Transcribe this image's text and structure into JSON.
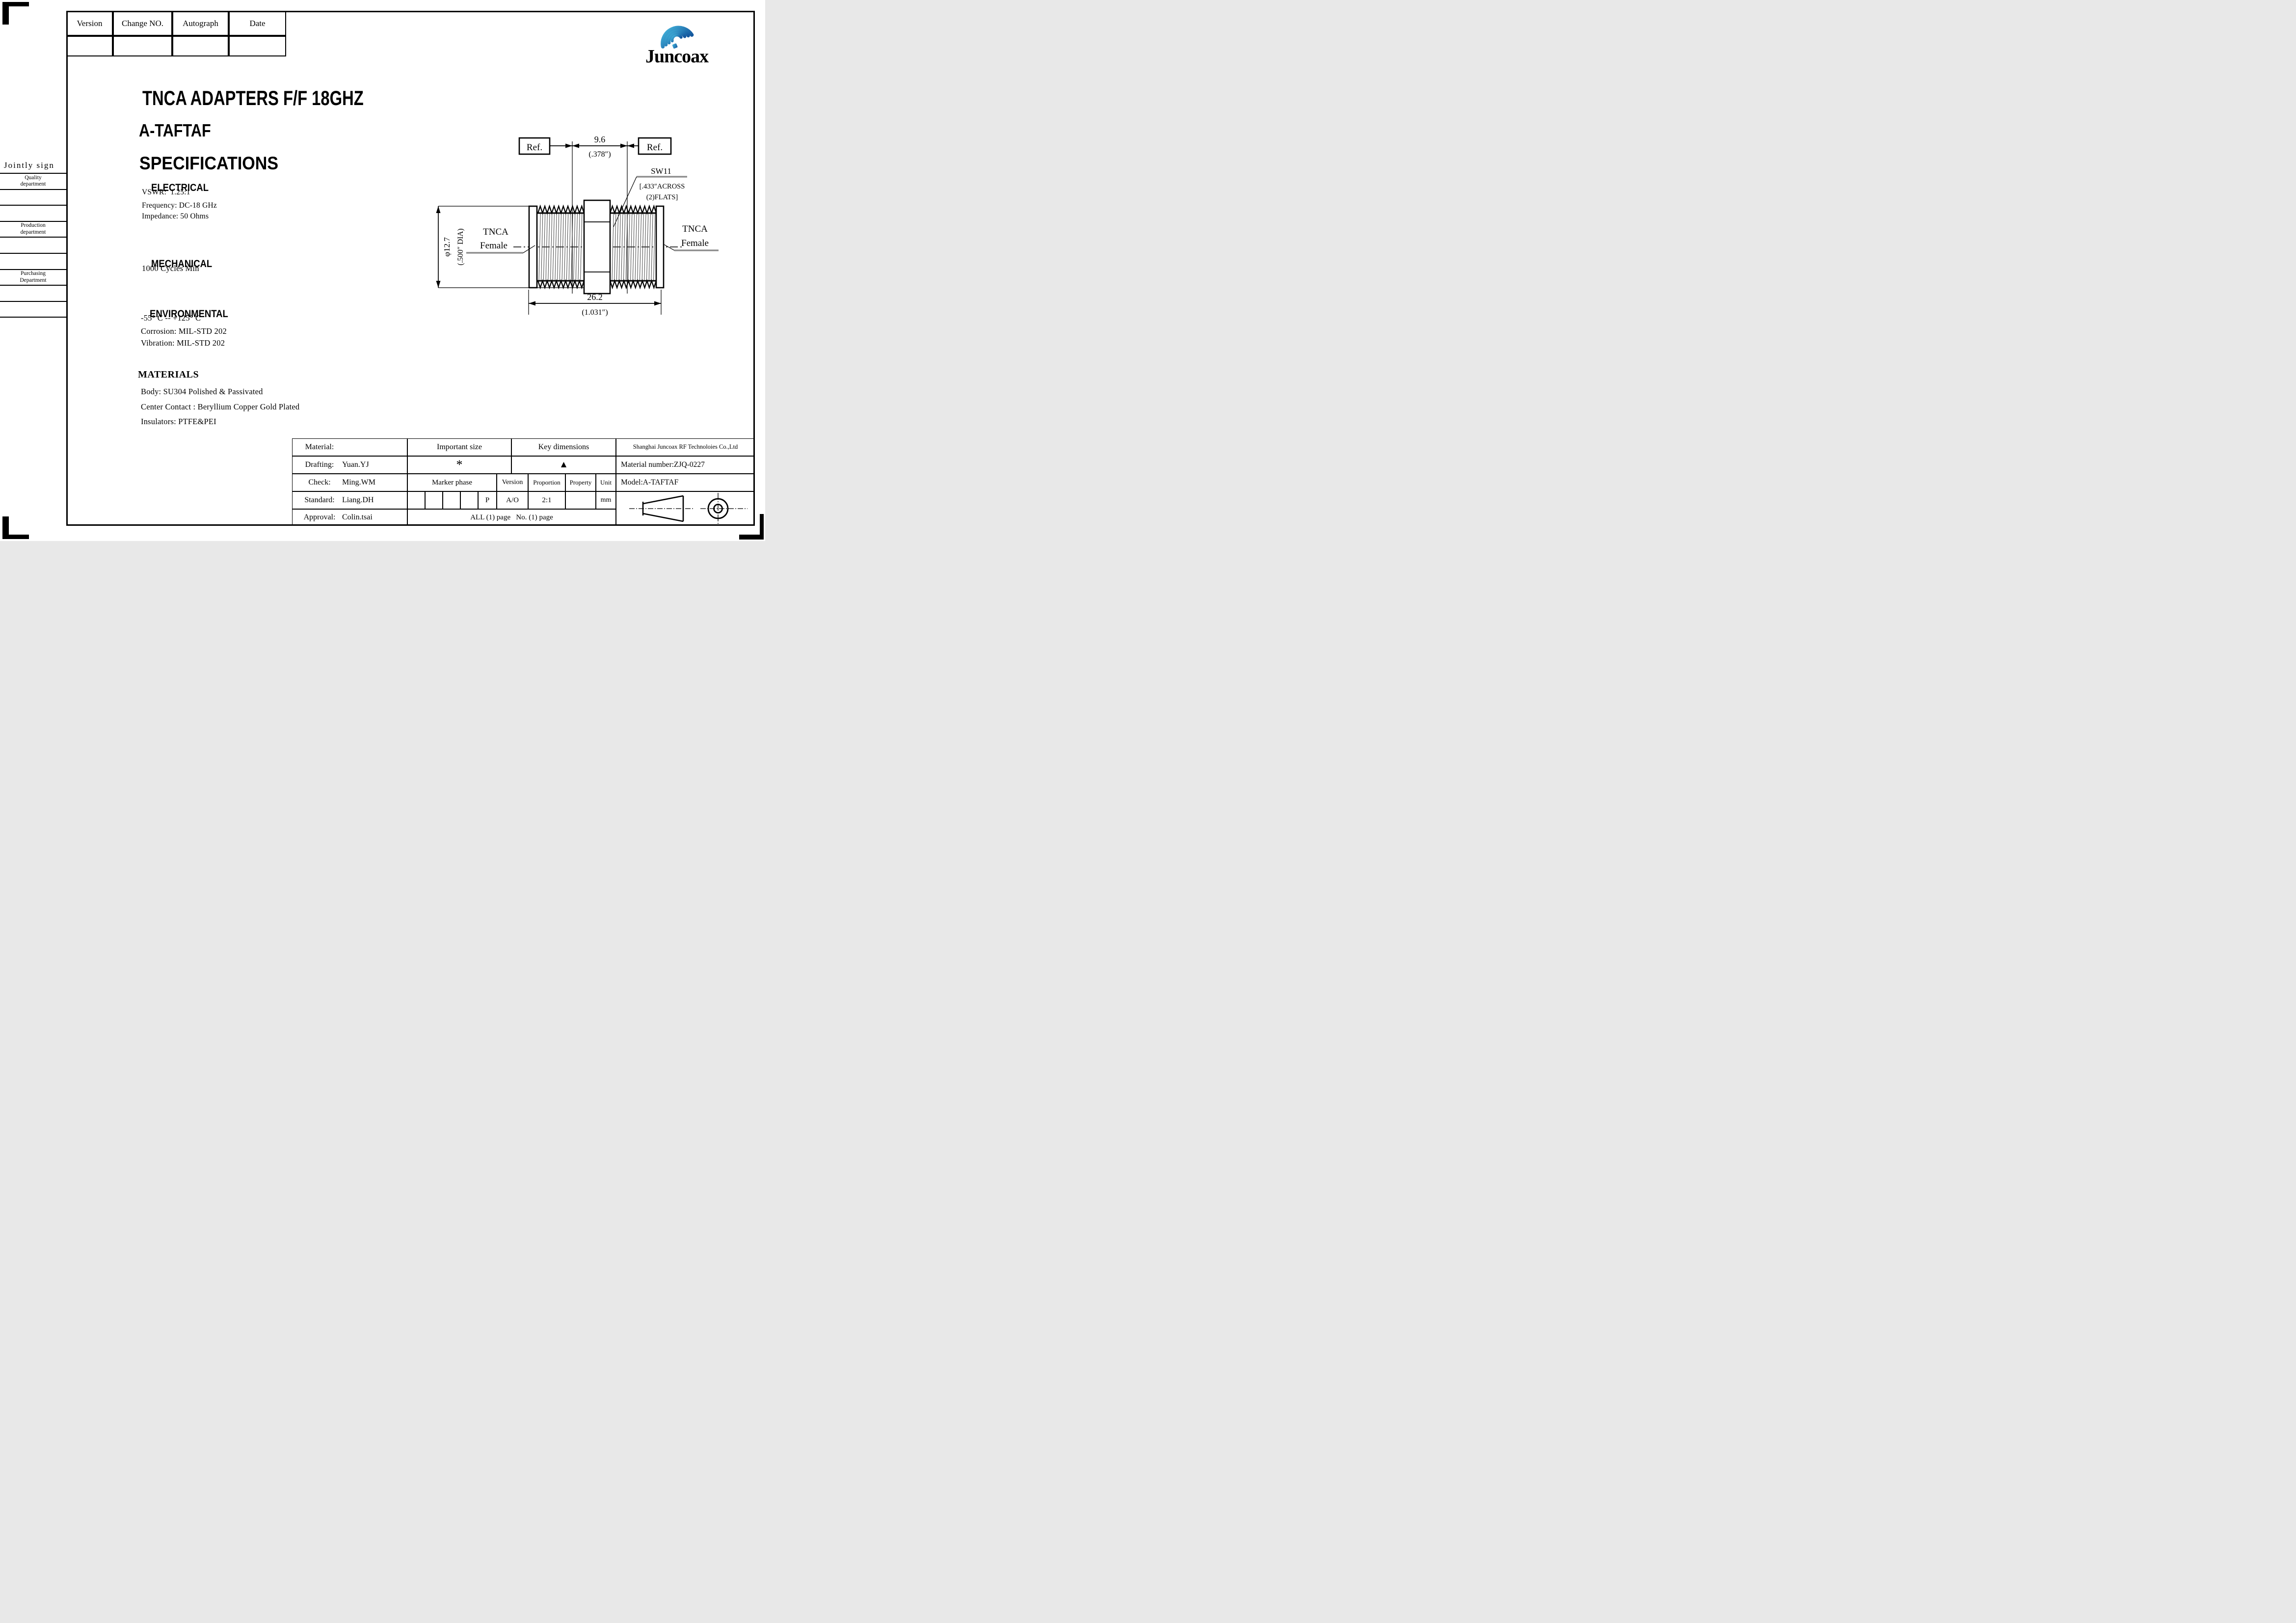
{
  "logo": {
    "text": "Juncoax",
    "blue": "#1b67b3"
  },
  "revision_table": {
    "headers": [
      "Version",
      "Change NO.",
      "Autograph",
      "Date"
    ]
  },
  "titles": {
    "main": "TNCA ADAPTERS F/F 18GHZ",
    "model": "A-TAFTAF",
    "section": "SPECIFICATIONS"
  },
  "signoff": {
    "header": "Jointly sign",
    "departments": [
      {
        "l1": "Quality",
        "l2": "department"
      },
      {
        "l1": "Production",
        "l2": "department"
      },
      {
        "l1": "Purchasing",
        "l2": "Department"
      }
    ]
  },
  "specs": {
    "electrical": {
      "heading": "ELECTRICAL",
      "lines": [
        "VSWR:  1.25:1",
        "Frequency: DC-18 GHz",
        "Impedance: 50 Ohms"
      ]
    },
    "mechanical": {
      "heading": "MECHANICAL",
      "lines": [
        "1000 Cycles Min"
      ]
    },
    "environmental": {
      "heading": "ENVIRONMENTAL",
      "lines": [
        "-55° C -- +125° C",
        "Corrosion: MIL-STD 202",
        "Vibration: MIL-STD 202"
      ]
    },
    "materials": {
      "heading": "MATERIALS",
      "lines": [
        "Body: SU304 Polished & Passivated",
        "Center Contact : Beryllium Copper Gold Plated",
        "Insulators: PTFE&PEI"
      ]
    }
  },
  "drawing": {
    "ref_left": "Ref.",
    "ref_right": "Ref.",
    "dim_width": {
      "mm": "9.6",
      "inch": "(.378″)"
    },
    "hex": {
      "label": "SW11",
      "note1": "[.433″ACROSS",
      "note2": "(2)FLATS]"
    },
    "dia": {
      "mm": "φ12.7",
      "inch": "(.500″ DIA)"
    },
    "left_port": {
      "l1": "TNCA",
      "l2": "Female"
    },
    "right_port": {
      "l1": "TNCA",
      "l2": "Female"
    },
    "dim_length": {
      "mm": "26.2",
      "inch": "(1.031″)"
    }
  },
  "title_block": {
    "material": {
      "label": "Material:",
      "value": ""
    },
    "drafting": {
      "label": "Drafting:",
      "value": "Yuan.YJ"
    },
    "check": {
      "label": "Check:",
      "value": "Ming.WM"
    },
    "standard": {
      "label": "Standard:",
      "value": "Liang.DH"
    },
    "approval": {
      "label": "Approval:",
      "value": "Colin.tsai"
    },
    "important_size": {
      "label": "Important size",
      "mark": "*"
    },
    "key_dimensions": {
      "label": "Key dimensions",
      "mark": "▲"
    },
    "marker_phase": "Marker phase",
    "p_mark": "P",
    "version": {
      "label": "Version",
      "value": "A/O"
    },
    "proportion": {
      "label": "Proportion",
      "value": "2:1"
    },
    "property": {
      "label": "Property",
      "value": ""
    },
    "unit": {
      "label": "Unit",
      "value": "mm"
    },
    "pages": "ALL (1) page   No. (1) page",
    "company": "Shanghai Juncoax RF Technoloies Co.,Ltd",
    "material_number": "Material number:ZJQ-0227",
    "model": "Model:A-TAFTAF"
  }
}
